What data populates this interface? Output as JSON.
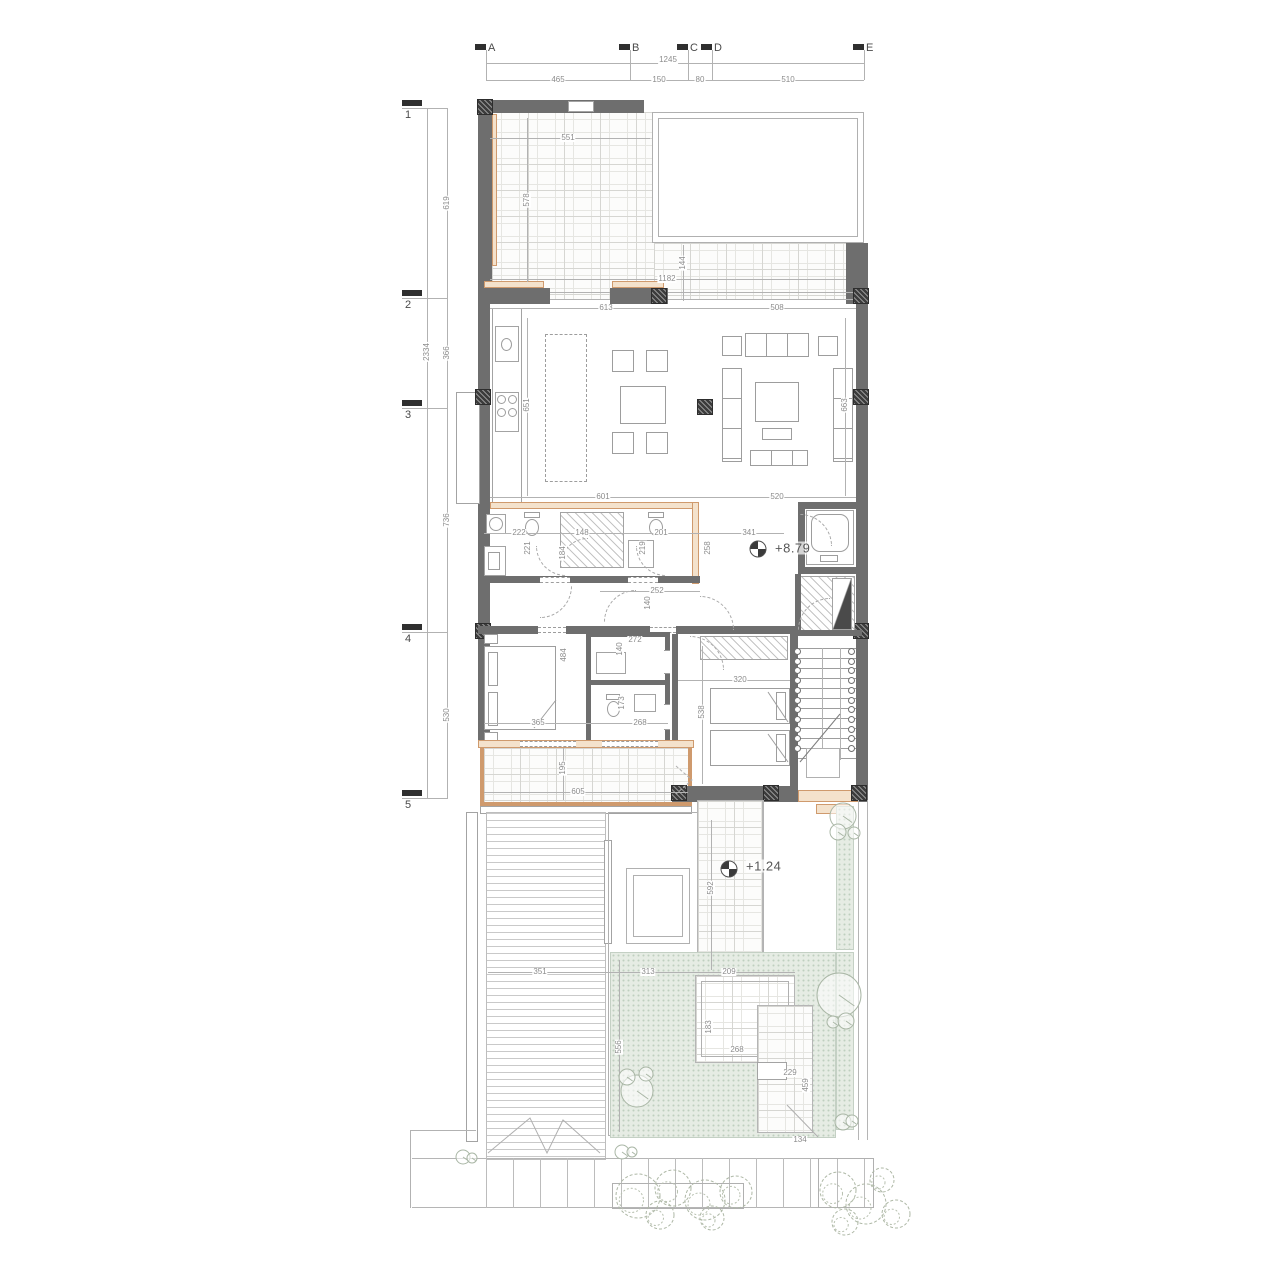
{
  "meta": {
    "drawing_type": "architectural floor plan",
    "upper_floor_level": "+8.79",
    "garden_level": "+1.24"
  },
  "grid_top": {
    "overall": "1245",
    "markers": [
      {
        "label": "A",
        "x": 486
      },
      {
        "label": "B",
        "x": 630
      },
      {
        "label": "C",
        "x": 688
      },
      {
        "label": "D",
        "x": 712
      },
      {
        "label": "E",
        "x": 864
      }
    ],
    "segments": [
      {
        "value": "465",
        "x": 558
      },
      {
        "value": "150",
        "x": 659
      },
      {
        "value": "80",
        "x": 700
      },
      {
        "value": "510",
        "x": 788
      }
    ]
  },
  "grid_left": {
    "overall": "2334",
    "markers": [
      {
        "label": "1",
        "y": 108
      },
      {
        "label": "2",
        "y": 298
      },
      {
        "label": "3",
        "y": 408
      },
      {
        "label": "4",
        "y": 632
      },
      {
        "label": "5",
        "y": 798
      }
    ],
    "segments": [
      {
        "value": "619",
        "y": 203
      },
      {
        "value": "366",
        "y": 353
      },
      {
        "value": "736",
        "y": 520
      },
      {
        "value": "530",
        "y": 715
      }
    ]
  },
  "levels": [
    {
      "value": "+8.79",
      "tx": 775,
      "ty": 548,
      "sx": 758,
      "sy": 549
    },
    {
      "value": "+1.24",
      "tx": 746,
      "ty": 866,
      "sx": 729,
      "sy": 869
    }
  ],
  "dimensions": [
    {
      "v": "551",
      "x": 568,
      "y": 138
    },
    {
      "v": "578",
      "x": 527,
      "y": 200,
      "r": 1
    },
    {
      "v": "1182",
      "x": 667,
      "y": 279
    },
    {
      "v": "144",
      "x": 683,
      "y": 263,
      "r": 1
    },
    {
      "v": "613",
      "x": 606,
      "y": 308
    },
    {
      "v": "508",
      "x": 777,
      "y": 308
    },
    {
      "v": "651",
      "x": 527,
      "y": 405,
      "r": 1
    },
    {
      "v": "663",
      "x": 845,
      "y": 405,
      "r": 1
    },
    {
      "v": "601",
      "x": 603,
      "y": 497
    },
    {
      "v": "520",
      "x": 777,
      "y": 497
    },
    {
      "v": "222",
      "x": 519,
      "y": 533
    },
    {
      "v": "221",
      "x": 528,
      "y": 548,
      "r": 1
    },
    {
      "v": "148",
      "x": 582,
      "y": 533
    },
    {
      "v": "184",
      "x": 563,
      "y": 553,
      "r": 1
    },
    {
      "v": "201",
      "x": 661,
      "y": 533
    },
    {
      "v": "219",
      "x": 643,
      "y": 548,
      "r": 1
    },
    {
      "v": "341",
      "x": 749,
      "y": 533
    },
    {
      "v": "258",
      "x": 708,
      "y": 548,
      "r": 1
    },
    {
      "v": "252",
      "x": 657,
      "y": 591
    },
    {
      "v": "140",
      "x": 648,
      "y": 603,
      "r": 1
    },
    {
      "v": "272",
      "x": 635,
      "y": 640
    },
    {
      "v": "140",
      "x": 620,
      "y": 649,
      "r": 1
    },
    {
      "v": "484",
      "x": 564,
      "y": 655,
      "r": 1
    },
    {
      "v": "320",
      "x": 740,
      "y": 680
    },
    {
      "v": "538",
      "x": 702,
      "y": 712,
      "r": 1
    },
    {
      "v": "365",
      "x": 538,
      "y": 723
    },
    {
      "v": "268",
      "x": 640,
      "y": 723
    },
    {
      "v": "173",
      "x": 622,
      "y": 703,
      "r": 1
    },
    {
      "v": "195",
      "x": 563,
      "y": 768,
      "r": 1
    },
    {
      "v": "605",
      "x": 578,
      "y": 792
    },
    {
      "v": "351",
      "x": 540,
      "y": 972
    },
    {
      "v": "313",
      "x": 648,
      "y": 972
    },
    {
      "v": "209",
      "x": 729,
      "y": 972
    },
    {
      "v": "592",
      "x": 711,
      "y": 888,
      "r": 1
    },
    {
      "v": "556",
      "x": 619,
      "y": 1047,
      "r": 1
    },
    {
      "v": "183",
      "x": 709,
      "y": 1027,
      "r": 1
    },
    {
      "v": "268",
      "x": 737,
      "y": 1050
    },
    {
      "v": "229",
      "x": 790,
      "y": 1073
    },
    {
      "v": "459",
      "x": 806,
      "y": 1085,
      "r": 1
    },
    {
      "v": "134",
      "x": 800,
      "y": 1140
    }
  ],
  "dim_lines": [
    [
      490,
      138,
      160,
      1
    ],
    [
      527,
      118,
      1,
      164
    ],
    [
      490,
      279,
      356,
      1
    ],
    [
      683,
      245,
      1,
      56
    ],
    [
      490,
      308,
      366,
      1
    ],
    [
      527,
      318,
      1,
      178
    ],
    [
      845,
      318,
      1,
      178
    ],
    [
      490,
      497,
      366,
      1
    ],
    [
      484,
      533,
      300,
      1
    ],
    [
      600,
      591,
      100,
      1
    ],
    [
      484,
      723,
      184,
      1
    ],
    [
      678,
      680,
      112,
      1
    ],
    [
      484,
      792,
      204,
      1
    ],
    [
      563,
      748,
      1,
      52
    ],
    [
      488,
      972,
      307,
      1
    ],
    [
      711,
      820,
      1,
      150
    ],
    [
      702,
      646,
      1,
      138
    ],
    [
      619,
      960,
      1,
      172
    ]
  ],
  "stairs": {
    "count": 11,
    "left_x": 797,
    "right_x": 851,
    "top_y": 651,
    "step": 9.7
  },
  "garden": {
    "trees": [
      {
        "x": 843,
        "y": 816,
        "r": 13
      },
      {
        "x": 854,
        "y": 833,
        "r": 6
      },
      {
        "x": 838,
        "y": 832,
        "r": 8
      },
      {
        "x": 839,
        "y": 995,
        "r": 22
      },
      {
        "x": 833,
        "y": 1022,
        "r": 6
      },
      {
        "x": 846,
        "y": 1021,
        "r": 8
      },
      {
        "x": 637,
        "y": 1091,
        "r": 16
      },
      {
        "x": 627,
        "y": 1077,
        "r": 8
      },
      {
        "x": 646,
        "y": 1074,
        "r": 7
      },
      {
        "x": 622,
        "y": 1152,
        "r": 7
      },
      {
        "x": 632,
        "y": 1152,
        "r": 5
      },
      {
        "x": 843,
        "y": 1122,
        "r": 8
      },
      {
        "x": 852,
        "y": 1121,
        "r": 6
      },
      {
        "x": 463,
        "y": 1157,
        "r": 7
      },
      {
        "x": 472,
        "y": 1158,
        "r": 5
      }
    ],
    "bushes": [
      {
        "x": 638,
        "y": 1196,
        "r": 22
      },
      {
        "x": 673,
        "y": 1188,
        "r": 18
      },
      {
        "x": 705,
        "y": 1200,
        "r": 20
      },
      {
        "x": 736,
        "y": 1192,
        "r": 16
      },
      {
        "x": 660,
        "y": 1215,
        "r": 14
      },
      {
        "x": 712,
        "y": 1218,
        "r": 12
      },
      {
        "x": 838,
        "y": 1190,
        "r": 18
      },
      {
        "x": 866,
        "y": 1204,
        "r": 20
      },
      {
        "x": 845,
        "y": 1222,
        "r": 13
      },
      {
        "x": 882,
        "y": 1180,
        "r": 12
      },
      {
        "x": 896,
        "y": 1214,
        "r": 14
      }
    ]
  },
  "colors": {
    "wall": "#6e6e6e",
    "column": "#3c3c3c",
    "accent_tan": "#cf9a6d",
    "garden_green": "#e6ece4",
    "line": "#b2b2b2",
    "dim_text": "#8c8c8c"
  }
}
